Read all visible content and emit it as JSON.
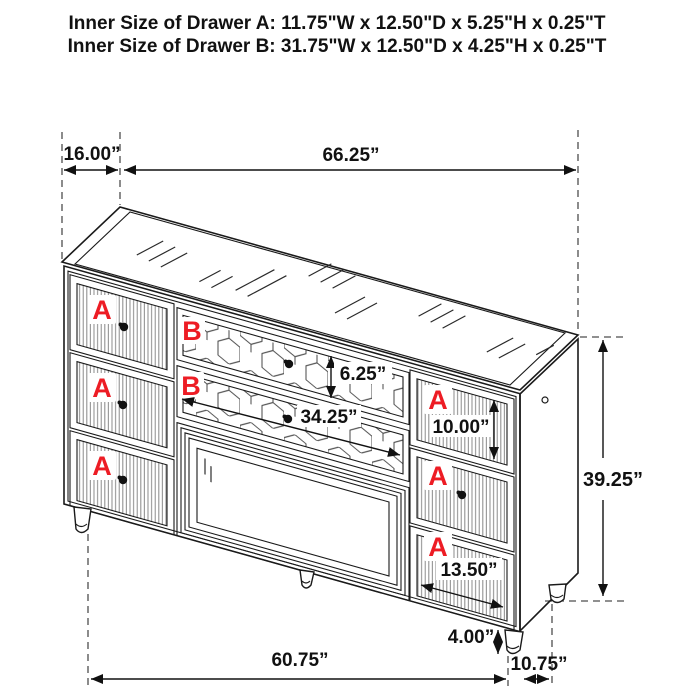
{
  "title": {
    "line_a": "Inner Size of Drawer A: 11.75\"W x 12.50\"D x 5.25\"H x 0.25\"T",
    "line_b": "Inner Size of Drawer B: 31.75\"W x 12.50\"D x 4.25\"H x 0.25\"T"
  },
  "drawer_labels": {
    "a": "A",
    "b": "B"
  },
  "dimensions": {
    "depth_top": "16.00”",
    "width_top": "66.25”",
    "drawer_b_height": "6.25”",
    "drawer_b_width": "34.25”",
    "drawer_a_height": "10.00”",
    "overall_height": "39.25”",
    "drawer_a_width": "13.50”",
    "leg_height": "4.00”",
    "width_bottom": "60.75”",
    "depth_bottom": "10.75”"
  },
  "colors": {
    "label_red": "#ed1c24",
    "line_black": "#1a1a1a",
    "dash_gray": "#4d4d4d",
    "background": "#ffffff"
  }
}
